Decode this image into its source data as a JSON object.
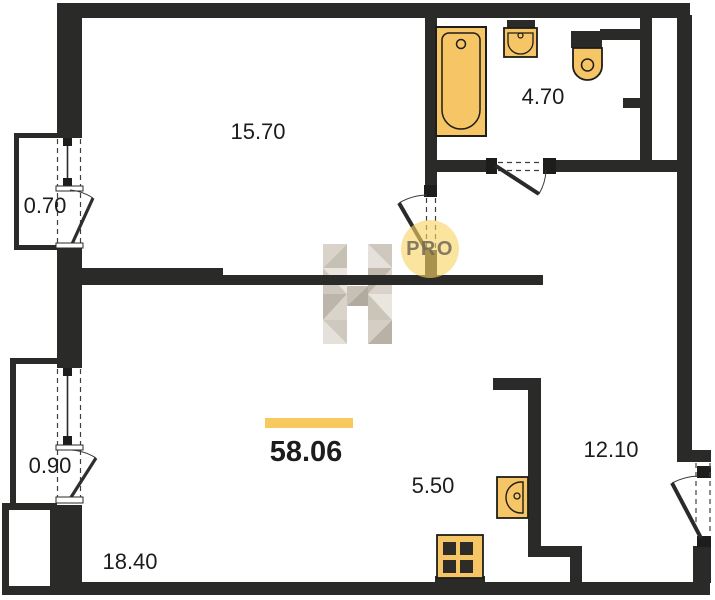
{
  "plan": {
    "title": "apartment-floor-plan",
    "total_area": "58.06",
    "rooms": [
      {
        "name": "room-top",
        "label": "15.70"
      },
      {
        "name": "bathroom",
        "label": "4.70"
      },
      {
        "name": "balcony-upper",
        "label": "0.70"
      },
      {
        "name": "balcony-lower",
        "label": "0.90"
      },
      {
        "name": "living-room",
        "label": "18.40"
      },
      {
        "name": "kitchen",
        "label": "5.50"
      },
      {
        "name": "room-right",
        "label": "12.10"
      }
    ],
    "watermark": {
      "letter": "H",
      "badge": "PRO"
    },
    "colors": {
      "wall": "#2a2a28",
      "fixture_fill": "#f6c566",
      "fixture_border": "#1f1d1a",
      "accent_bar": "#f8c95e",
      "watermark_circle": "#f7d363",
      "watermark_text": "#6e6758"
    }
  }
}
